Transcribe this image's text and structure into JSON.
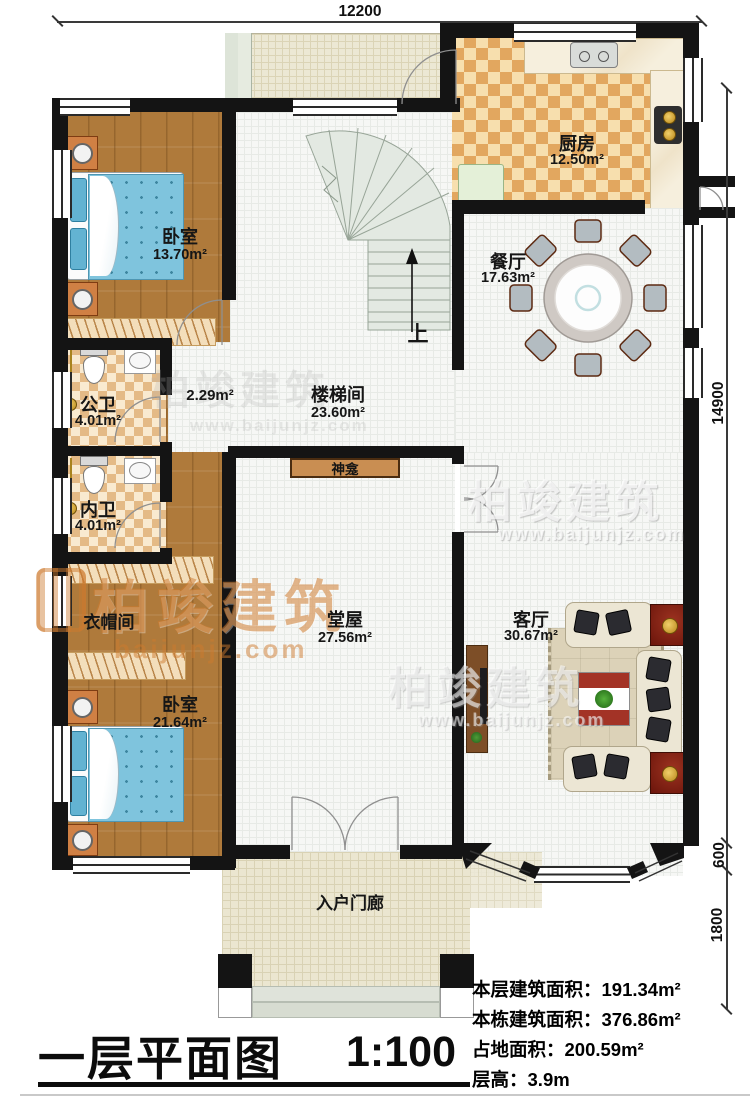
{
  "title": {
    "name": "一层平面图",
    "scale": "1:100"
  },
  "dimensions": {
    "top": "12200",
    "right_total": "14900",
    "right_bay": "600",
    "right_porch": "1800"
  },
  "stats": [
    {
      "label": "本层建筑面积：",
      "value": "191.34m²"
    },
    {
      "label": "本栋建筑面积：",
      "value": "376.86m²"
    },
    {
      "label": "占地面积：",
      "value": "200.59m²"
    },
    {
      "label": "层高：",
      "value": "3.9m"
    }
  ],
  "rooms": {
    "bedroom_top": {
      "name": "卧室",
      "area": "13.70m²"
    },
    "public_bath": {
      "name": "公卫",
      "area": "4.01m²"
    },
    "private_bath": {
      "name": "内卫",
      "area": "4.01m²"
    },
    "cloakroom": {
      "name": "衣帽间"
    },
    "bedroom_bottom": {
      "name": "卧室",
      "area": "21.64m²"
    },
    "stair_hall": {
      "name": "楼梯间",
      "area": "23.60m²"
    },
    "small_hall": {
      "area": "2.29m²"
    },
    "kitchen": {
      "name": "厨房",
      "area": "12.50m²"
    },
    "dining": {
      "name": "餐厅",
      "area": "17.63m²"
    },
    "main_hall": {
      "name": "堂屋",
      "area": "27.56m²"
    },
    "living": {
      "name": "客厅",
      "area": "30.67m²"
    },
    "porch": {
      "name": "入户门廊"
    },
    "shrine": {
      "name": "神龛"
    },
    "stairs_up": {
      "label": "上"
    }
  },
  "watermark": {
    "brand": "柏竣建筑",
    "site": "www.baijunjz.com",
    "site_short": "baijunjz.com"
  },
  "colors": {
    "wall": "#141414",
    "wood_floor": "#af7a3b",
    "tile_floor": "#f6f7f5",
    "kitchen_checker": "#e2a75f",
    "bath_checker": "#e4ba86",
    "terrace": "#ece8d4",
    "bed_blue": "#7fc4dd",
    "shrine_wood": "#c98e52",
    "accent_red": "#7a1e10"
  }
}
